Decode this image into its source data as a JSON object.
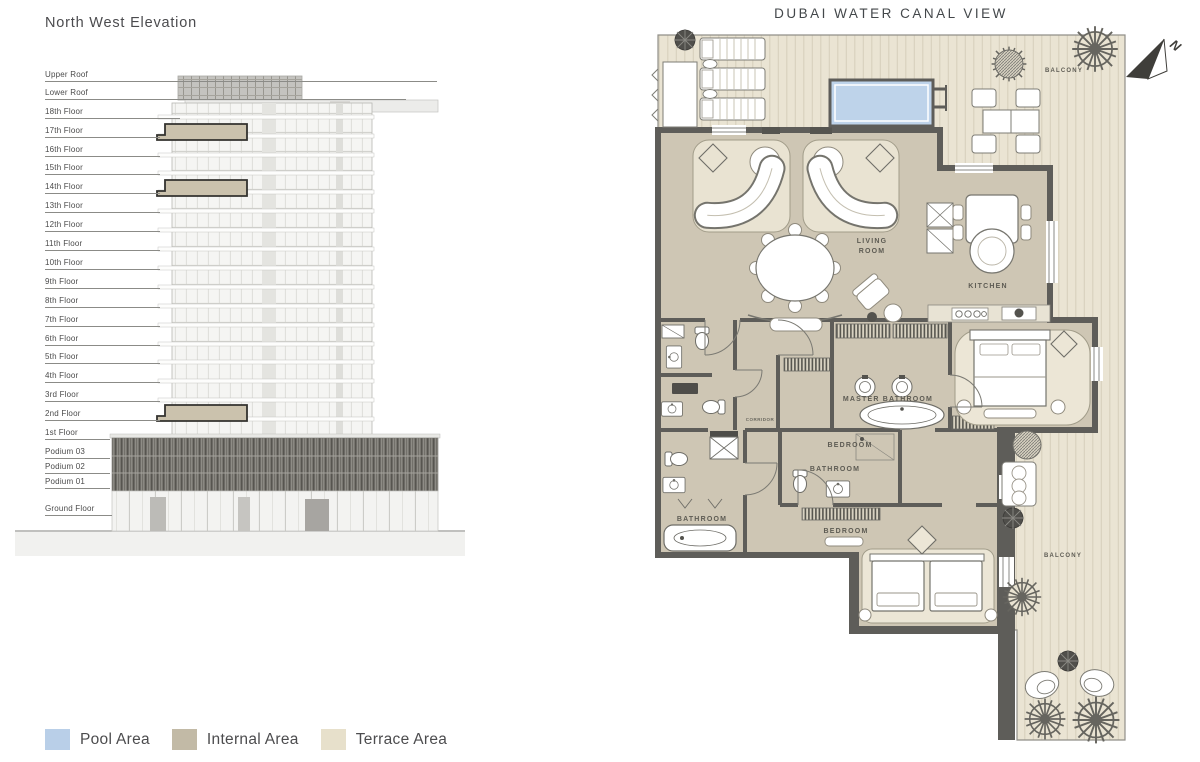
{
  "elevation": {
    "title": "North West Elevation",
    "floors": [
      "Upper Roof",
      "Lower Roof",
      "18th Floor",
      "17th Floor",
      "16th Floor",
      "15th Floor",
      "14th Floor",
      "13th Floor",
      "12th Floor",
      "11th Floor",
      "10th Floor",
      "9th Floor",
      "8th Floor",
      "7th Floor",
      "6th Floor",
      "5th Floor",
      "4th Floor",
      "3rd Floor",
      "2nd Floor",
      "1st Floor",
      "Podium 03",
      "Podium 02",
      "Podium 01",
      "Ground Floor"
    ]
  },
  "floorplan": {
    "title": "DUBAI WATER CANAL VIEW",
    "north_label": "N",
    "labels": {
      "living_1": "LIVING",
      "living_2": "ROOM",
      "kitchen": "KITCHEN",
      "master_bathroom": "MASTER BATHROOM",
      "bedroom_upper": "BEDROOM",
      "bathroom_middle": "BATHROOM",
      "bathroom_corner": "BATHROOM",
      "bedroom_lower": "BEDROOM",
      "balcony_top": "BALCONY",
      "balcony_right": "BALCONY",
      "corridor": "CORRIDOR"
    }
  },
  "legend": {
    "items": [
      {
        "label": "Pool Area",
        "color": "#b9cfe8"
      },
      {
        "label": "Internal Area",
        "color": "#c2baa6"
      },
      {
        "label": "Terrace Area",
        "color": "#e7e0cb"
      }
    ]
  },
  "colors": {
    "internal_area": "#cec6b4",
    "terrace_area": "#eae4d3",
    "pool_area": "#bed3ea",
    "wall": "#5e5d59",
    "unit_highlight": "#cbc2ad"
  }
}
